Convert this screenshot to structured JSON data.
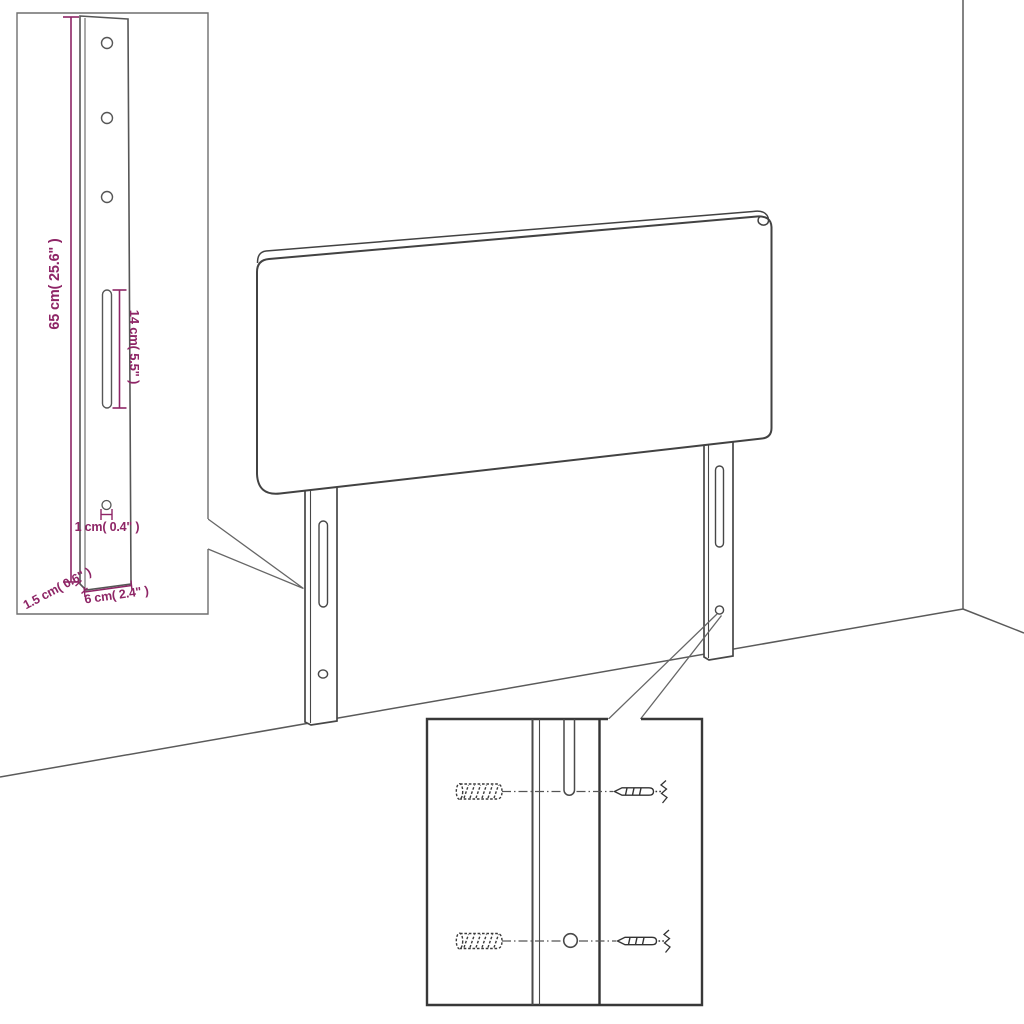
{
  "meta": {
    "type": "assembly-dimension-diagram",
    "subject": "headboard-with-mounting-legs"
  },
  "colors": {
    "accent": "#8e2566",
    "line": "#474747",
    "background": "#ffffff"
  },
  "dimension_inset": {
    "labels": {
      "leg_height": "65 cm( 25.6\" )",
      "slot_length": "14 cm( 5.5\" )",
      "hole_diameter": "1 cm( 0.4\" )",
      "leg_thickness": "1.5 cm( 0.6\" )",
      "leg_width": "6 cm( 2.4\" )"
    }
  },
  "hardware_inset": {
    "icons": [
      "wall-plug-icon",
      "screw-icon",
      "leg-slot",
      "leg-hole"
    ],
    "rows": 2
  }
}
